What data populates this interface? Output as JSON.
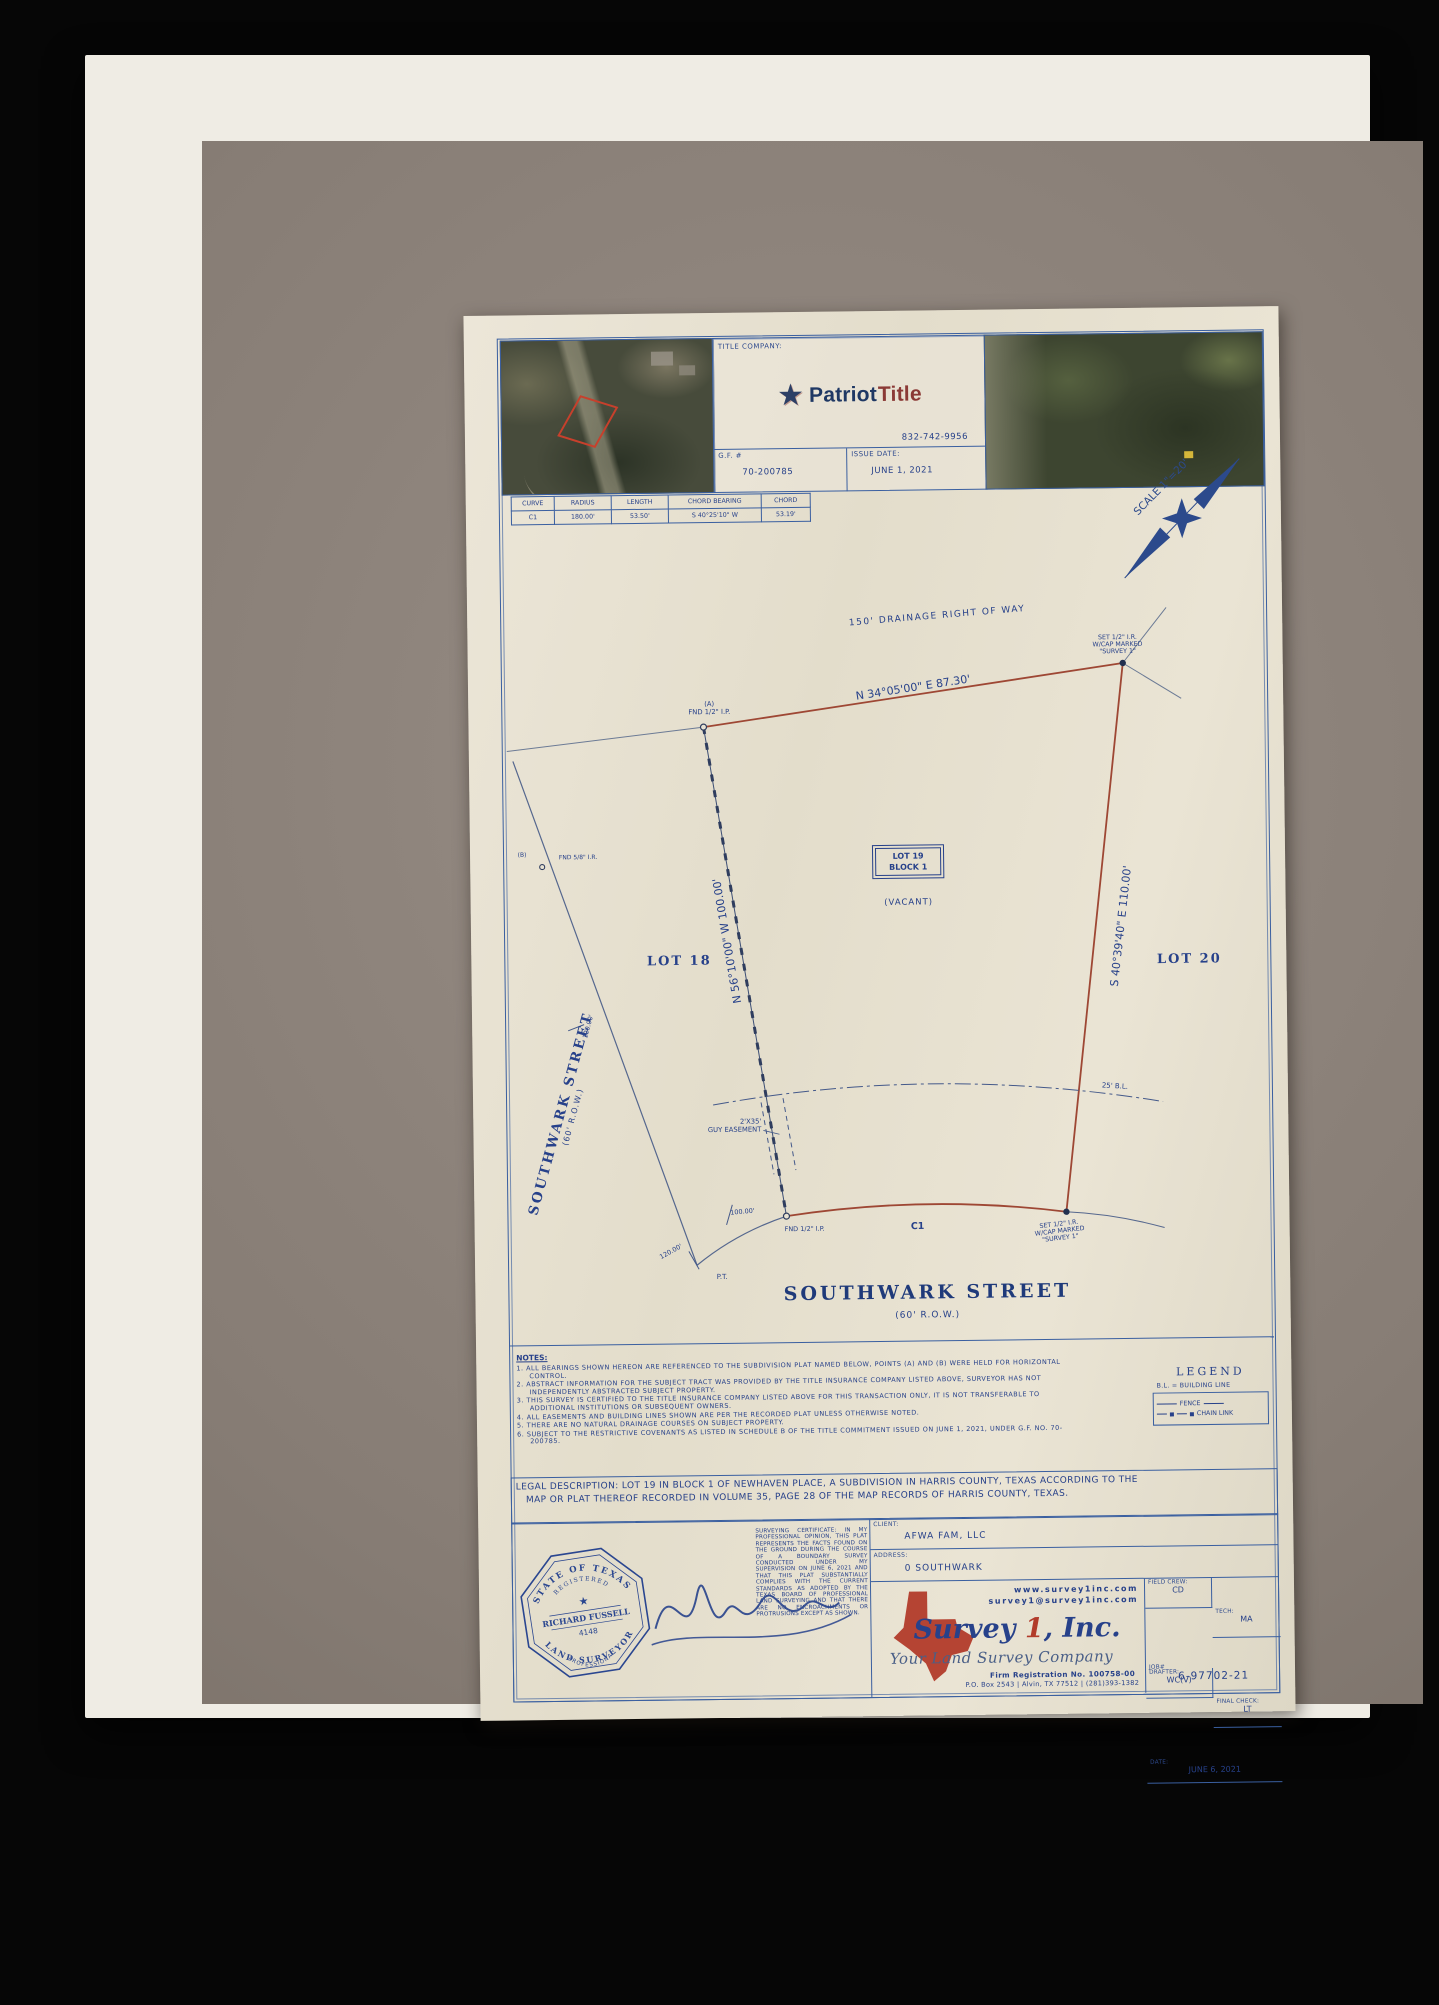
{
  "header": {
    "title_company_label": "TITLE COMPANY:",
    "brand_part1": "Patriot",
    "brand_part2": "Title",
    "phone": "832-742-9956",
    "gf_label": "G.F. #",
    "gf_value": "70-200785",
    "issue_date_label": "ISSUE DATE:",
    "issue_date_value": "JUNE 1, 2021"
  },
  "curve_table": {
    "headers": [
      "CURVE",
      "RADIUS",
      "LENGTH",
      "CHORD BEARING",
      "CHORD"
    ],
    "row": [
      "C1",
      "180.00'",
      "53.50'",
      "S 40°25'10\" W",
      "53.19'"
    ]
  },
  "north_arrow": {
    "scale_label": "SCALE 1\"=20'"
  },
  "plat": {
    "drainage_row": "150' DRAINAGE RIGHT OF WAY",
    "bearing_top": "N 34°05'00\" E  87.30'",
    "bearing_left": "N 56°10'00\" W  100.00'",
    "bearing_right": "S 40°39'40\" E  110.00'",
    "lot18": "LOT 18",
    "lot20": "LOT 20",
    "lot19_line1": "LOT 19",
    "lot19_line2": "BLOCK 1",
    "vacant": "(VACANT)",
    "corner_a_tag": "(A)",
    "corner_a": "FND 1/2\" I.P.",
    "corner_b_l1": "SET 1/2\" I.R.",
    "corner_b_l2": "W/CAP MARKED",
    "corner_b_l3": "\"SURVEY 1\"",
    "corner_c": "FND 1/2\" I.P.",
    "corner_d_l1": "SET 1/2\" I.R.",
    "corner_d_l2": "W/CAP MARKED",
    "corner_d_l3": "\"SURVEY 1\"",
    "marker_b_tag": "(B)",
    "marker_b": "FND 5/8\" I.R.",
    "guy_l1": "2'X35'",
    "guy_l2": "GUY EASEMENT",
    "building_line": "25' B.L.",
    "curve_label": "C1",
    "dist_100": "100.00'",
    "dist_120_upper": "120.00'",
    "dist_120_lower": "120.00'",
    "pt_label": "P.T.",
    "street_left_name": "SOUTHWARK STREET",
    "street_left_row": "(60' R.O.W.)",
    "street_bottom_name": "SOUTHWARK STREET",
    "street_bottom_row": "(60' R.O.W.)"
  },
  "notes": {
    "title": "NOTES:",
    "items": [
      "1.  ALL BEARINGS SHOWN HEREON ARE REFERENCED TO THE SUBDIVISION PLAT NAMED BELOW, POINTS (A) AND (B) WERE HELD FOR HORIZONTAL CONTROL.",
      "2.  ABSTRACT INFORMATION FOR THE SUBJECT TRACT WAS PROVIDED BY THE TITLE INSURANCE COMPANY LISTED ABOVE, SURVEYOR HAS NOT INDEPENDENTLY ABSTRACTED SUBJECT PROPERTY.",
      "3.  THIS SURVEY IS CERTIFIED TO THE TITLE INSURANCE COMPANY LISTED ABOVE FOR THIS TRANSACTION ONLY, IT IS NOT TRANSFERABLE TO ADDITIONAL INSTITUTIONS OR SUBSEQUENT OWNERS.",
      "4.  ALL EASEMENTS AND BUILDING LINES SHOWN ARE PER THE RECORDED PLAT UNLESS OTHERWISE NOTED.",
      "5.  THERE ARE NO NATURAL DRAINAGE COURSES ON SUBJECT PROPERTY.",
      "6.  SUBJECT TO THE RESTRICTIVE COVENANTS AS LISTED IN SCHEDULE B OF THE TITLE COMMITMENT ISSUED ON JUNE 1, 2021, UNDER G.F. NO. 70-200785."
    ]
  },
  "legend": {
    "title": "LEGEND",
    "building_line": "B.L.  =  BUILDING LINE",
    "fence": "FENCE",
    "chain_link": "CHAIN LINK"
  },
  "legal": {
    "line1": "LEGAL DESCRIPTION: LOT 19 IN BLOCK 1 OF NEWHAVEN PLACE, A SUBDIVISION IN HARRIS COUNTY, TEXAS ACCORDING TO THE",
    "line2": "MAP OR PLAT THEREOF RECORDED IN VOLUME 35, PAGE 28 OF THE MAP RECORDS OF HARRIS COUNTY, TEXAS."
  },
  "certificate": {
    "text": "SURVEYING CERTIFICATE: IN MY PROFESSIONAL OPINION, THIS PLAT REPRESENTS THE FACTS FOUND ON THE GROUND DURING THE COURSE OF A BOUNDARY SURVEY CONDUCTED UNDER MY SUPERVISION ON JUNE 6, 2021 AND THAT THIS PLAT SUBSTANTIALLY COMPLIES WITH THE CURRENT STANDARDS AS ADOPTED BY THE TEXAS BOARD OF PROFESSIONAL LAND SURVEYING AND THAT THERE ARE NO ENCROACHMENTS OR PROTRUSIONS EXCEPT AS SHOWN."
  },
  "seal": {
    "arc_top": "STATE OF TEXAS",
    "registered": "REGISTERED",
    "name": "RICHARD FUSSELL",
    "number": "4148",
    "professional": "PROFESSIONAL",
    "arc_bottom": "LAND SURVEYOR"
  },
  "footer": {
    "client_label": "CLIENT:",
    "client_value": "AFWA FAM, LLC",
    "address_label": "ADDRESS:",
    "address_value": "0 SOUTHWARK",
    "website": "www.survey1inc.com",
    "email": "survey1@survey1inc.com",
    "company_part1": "Survey",
    "company_part2": " 1",
    "company_part3": ", Inc.",
    "tagline": "Your Land Survey Company",
    "firm_reg": "Firm Registration No. 100758-00",
    "po_line": "P.O. Box 2543 | Alvin, TX 77512 | (281)393-1382",
    "field_crew_label": "FIELD CREW:",
    "field_crew_value": "CD",
    "tech_label": "TECH:",
    "tech_value": "MA",
    "drafter_label": "DRAFTER:",
    "drafter_value": "WC(V)",
    "final_check_label": "FINAL CHECK:",
    "final_check_value": "LT",
    "date_label": "DATE:",
    "date_value": "JUNE 6, 2021",
    "job_label": "JOB#",
    "job_value": "6-97702-21"
  }
}
